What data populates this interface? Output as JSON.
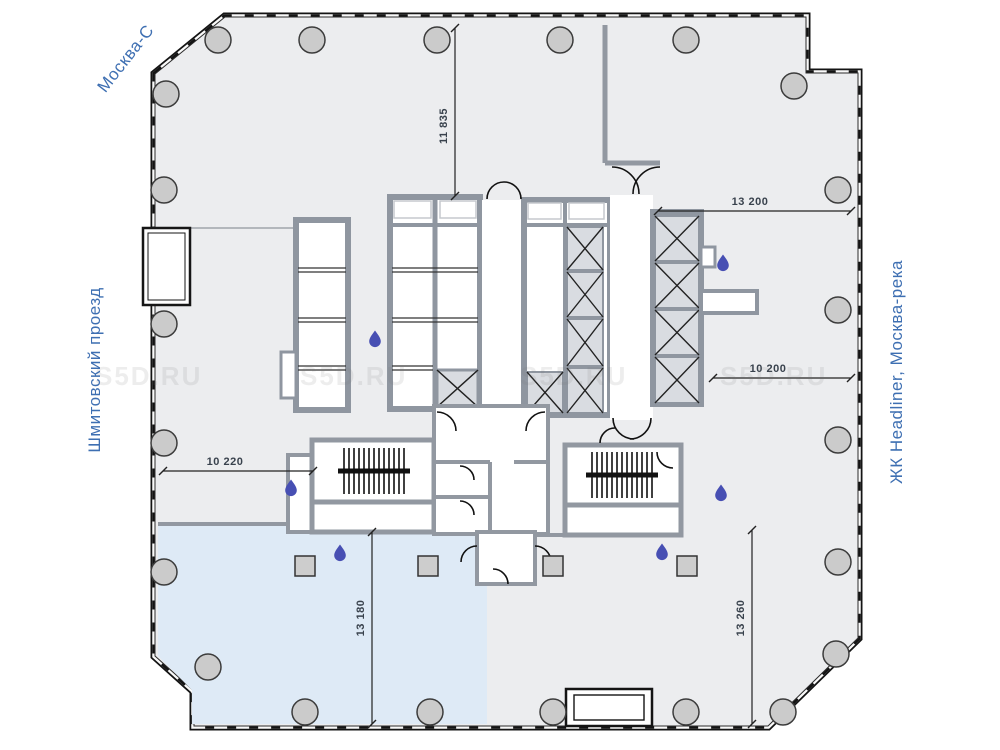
{
  "plan": {
    "streets": {
      "top_left": "Москва-С",
      "left": "Шмитовский проезд",
      "right": "ЖК Headliner, Москва-река"
    },
    "dimensions": [
      {
        "value": "11 835",
        "orientation": "vertical"
      },
      {
        "value": "13 200",
        "orientation": "horizontal"
      },
      {
        "value": "10 200",
        "orientation": "horizontal"
      },
      {
        "value": "10 220",
        "orientation": "horizontal"
      },
      {
        "value": "13 180",
        "orientation": "vertical"
      },
      {
        "value": "13 260",
        "orientation": "vertical"
      }
    ],
    "watermark": "S5D.RU",
    "colors": {
      "floor": "#ECEDEF",
      "highlight_area": "#DEEAF6",
      "wall_gray": "#9298A1",
      "shaft_fill": "#D9DCE1",
      "street_label": "#3E6FB2",
      "water_drop": "#474FB3",
      "outline": "#141414",
      "column_fill": "#CBCBCB"
    },
    "icons": {
      "column": "structural-column",
      "water_drop": "wet-point-drop",
      "shaft": "elevator-shaft-x",
      "stairs": "staircase"
    }
  }
}
